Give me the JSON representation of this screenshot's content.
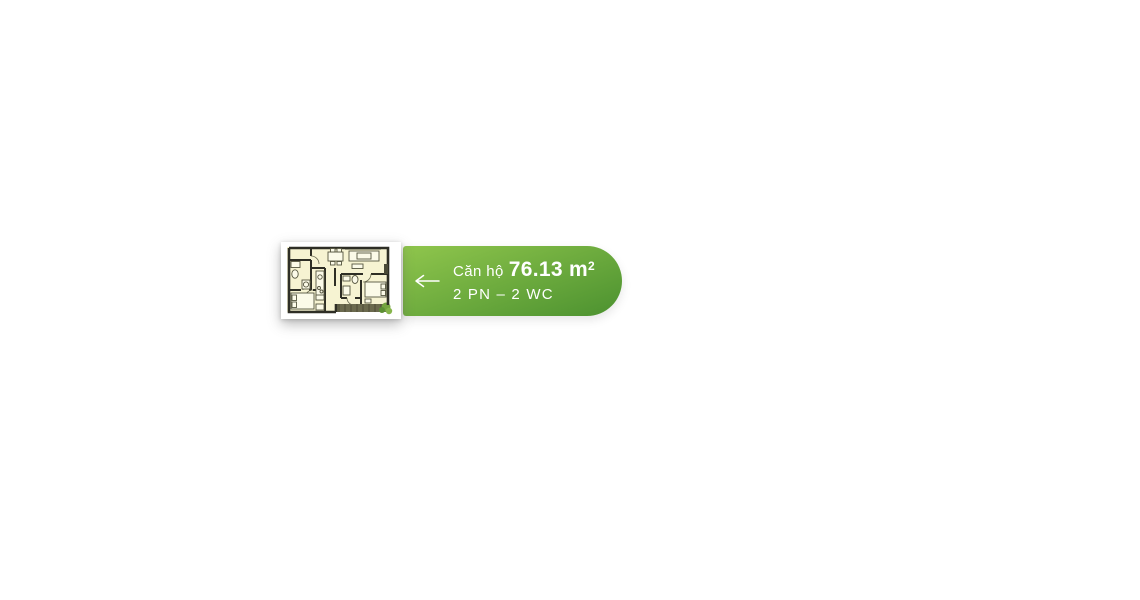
{
  "banner": {
    "label_prefix": "Căn hộ",
    "area": "76.13 m",
    "area_sup": "2",
    "rooms": "2 PN – 2 WC",
    "gradient_top": "#8cc34b",
    "gradient_bottom": "#4f9431"
  },
  "icons": {
    "back_arrow": "⟵",
    "floor_plan": "apartment-floor-plan-thumbnail"
  }
}
